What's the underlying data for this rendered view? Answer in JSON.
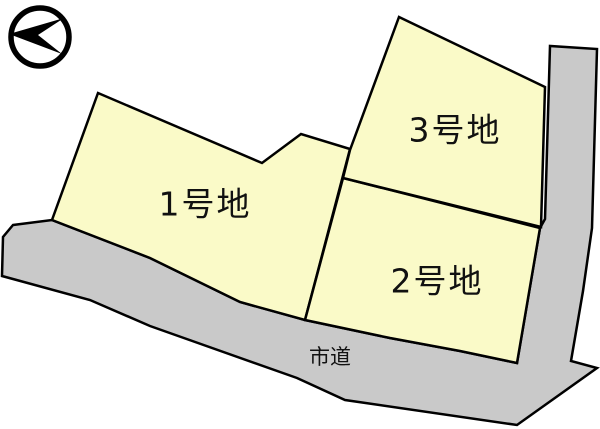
{
  "diagram": {
    "type": "land-lot-plan",
    "canvas": {
      "width": 600,
      "height": 429
    },
    "colors": {
      "background": "#ffffff",
      "parcel_fill": "#FAFAC8",
      "road_fill": "#C9C9C9",
      "outline": "#000000"
    },
    "stroke_width": 2.5,
    "road": {
      "label": "市道",
      "label_x": 330,
      "label_y": 357,
      "label_font_size": 21,
      "points": [
        [
          13,
          225
        ],
        [
          52,
          220
        ],
        [
          150,
          258
        ],
        [
          240,
          302
        ],
        [
          305,
          320
        ],
        [
          390,
          338
        ],
        [
          460,
          351
        ],
        [
          517,
          363
        ],
        [
          540,
          228
        ],
        [
          545,
          219
        ],
        [
          550,
          46
        ],
        [
          597,
          49
        ],
        [
          592,
          228
        ],
        [
          583,
          291
        ],
        [
          571,
          361
        ],
        [
          597,
          368
        ],
        [
          517,
          425
        ],
        [
          345,
          400
        ],
        [
          297,
          378
        ],
        [
          150,
          326
        ],
        [
          90,
          300
        ],
        [
          2,
          276
        ],
        [
          3,
          237
        ]
      ]
    },
    "parcels": [
      {
        "id": "lot-1",
        "label": "1号地",
        "label_x": 205,
        "label_y": 204,
        "label_font_size": 33,
        "points": [
          [
            98,
            93
          ],
          [
            262,
            163
          ],
          [
            301,
            134
          ],
          [
            350,
            149
          ],
          [
            305,
            320
          ],
          [
            240,
            302
          ],
          [
            150,
            258
          ],
          [
            52,
            220
          ]
        ]
      },
      {
        "id": "lot-2",
        "label": "2号地",
        "label_x": 437,
        "label_y": 281,
        "label_font_size": 33,
        "points": [
          [
            343,
            178
          ],
          [
            540,
            228
          ],
          [
            517,
            363
          ],
          [
            460,
            351
          ],
          [
            390,
            338
          ],
          [
            305,
            320
          ]
        ]
      },
      {
        "id": "lot-3",
        "label": "3号地",
        "label_x": 455,
        "label_y": 130,
        "label_font_size": 33,
        "points": [
          [
            399,
            17
          ],
          [
            545,
            87
          ],
          [
            541,
            227
          ],
          [
            343,
            178
          ],
          [
            350,
            150
          ]
        ]
      }
    ],
    "compass": {
      "name": "north-arrow",
      "cx": 40,
      "cy": 37,
      "r": 29,
      "ring_width": 5.5,
      "arrow_points": [
        [
          9,
          34
        ],
        [
          64,
          18
        ],
        [
          38,
          35
        ],
        [
          62,
          54
        ]
      ]
    }
  }
}
